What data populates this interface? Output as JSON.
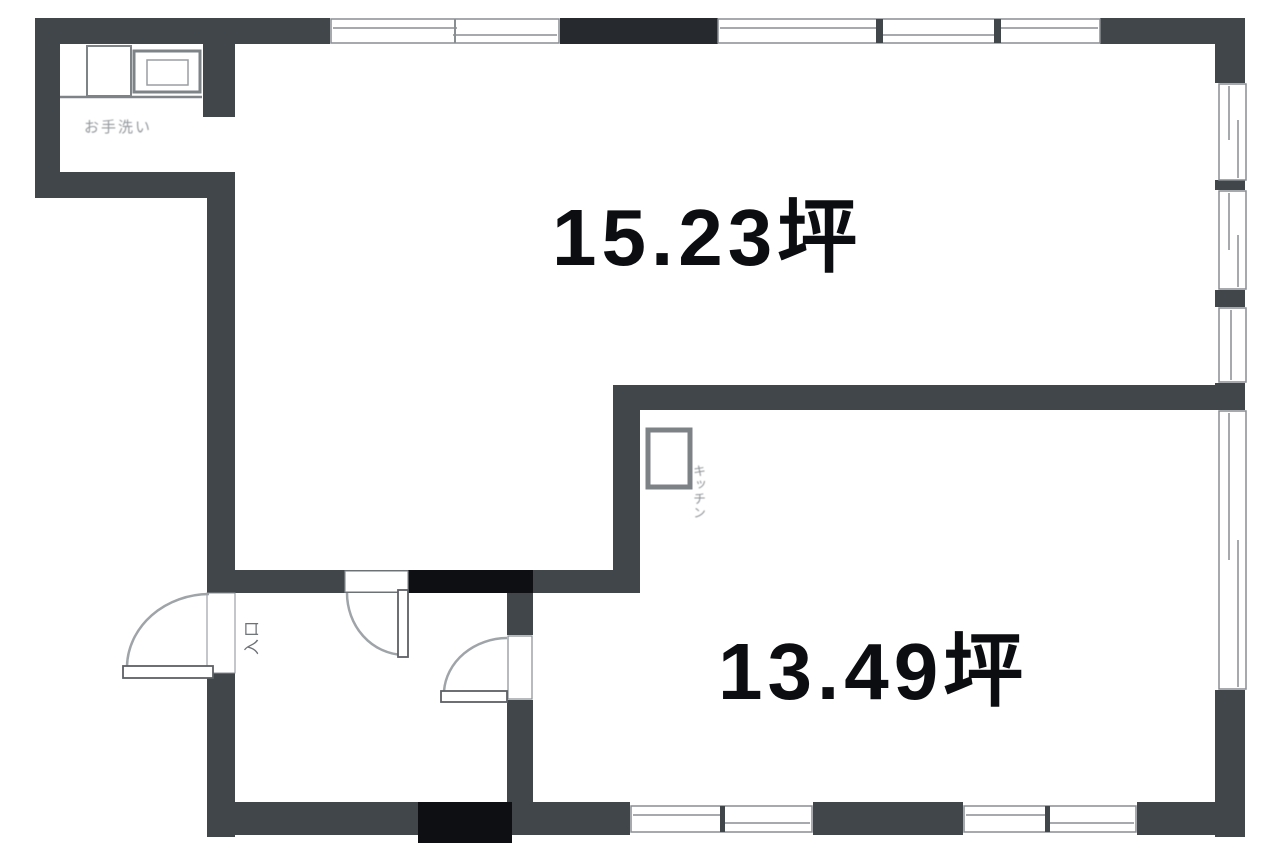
{
  "labels": {
    "room_main": "15.23坪",
    "room_second": "13.49坪",
    "entrance": "入口",
    "kitchen": "キッチン",
    "washroom": "お手洗い"
  },
  "colors": {
    "wall": "#41464b",
    "wall_dark": "#26292d",
    "wall_black": "#0d0f12",
    "line": "#898e93",
    "arc": "#9fa4a9",
    "leaf": "#5c6166",
    "text": "#0b0d10",
    "muted": "#94989c",
    "bg": "#ffffff"
  }
}
